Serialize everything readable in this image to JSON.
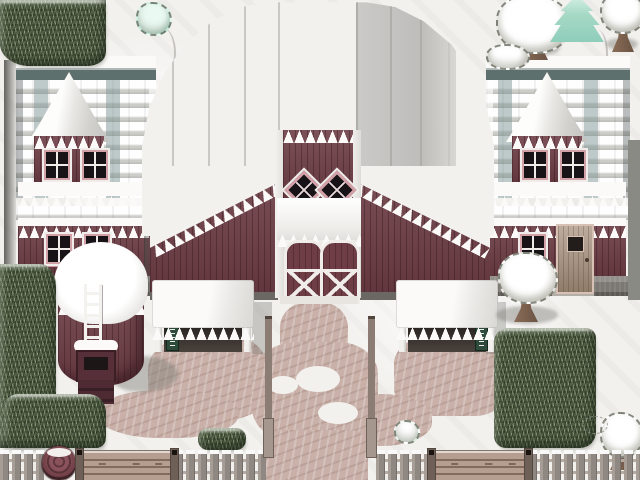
{
  "scene": {
    "type": "game-map",
    "style": "top-down 16-bit RPG tile map",
    "setting": "snow-covered red barn farmstead with silo, stalls, hedges and picket fence",
    "viewport": {
      "width": 640,
      "height": 480
    },
    "visible_text": "none"
  },
  "palette": {
    "snow": "#f3f1ee",
    "snow_bright": "#fbfaf8",
    "snow_shadow": "#dedcd8",
    "barn_red": "#6e3d45",
    "barn_red_dark": "#572f38",
    "trim_white": "#efece9",
    "trim_pink": "#d2a0a7",
    "sill_pink": "#cf9aa0",
    "roof_gray": "#c7c6c3",
    "roof_gray_dark": "#adadaa",
    "teal_shade": "#7e9694",
    "teal_dark": "#5e706e",
    "dirt": "#c9b1a9",
    "dirt_dark": "#b79e96",
    "grass_green": "#515f46",
    "grass_dark": "#39462f",
    "grass_light": "#a3b48a",
    "pine_teal": "#a6d9c6",
    "trunk_brown": "#7c6150",
    "fence_gray": "#9b938c",
    "fence_rail": "#b5aaa1",
    "gate_wood": "#b59d90",
    "gate_post": "#6f6057",
    "opening_dark": "#342e2b",
    "sign_green": "#2e4a3a",
    "foundation_gray": "#7b7772",
    "pane_black": "#171317",
    "door_wood": "#a8927e",
    "door_trim": "#d6c1b4",
    "ladder_white": "#f4f2ef"
  },
  "objects": {
    "viewport": "Snow-covered farmstead map",
    "barn_roof": "Large snow-covered gambrel barn roof",
    "barn_gable": "Red barn gable with icicles",
    "diamond_window": "Diamond window with four panes",
    "barn_doors": "White-framed barn double doors",
    "left_wing": "Left stable wing with dormer",
    "right_wing": "Right stable wing with dormer",
    "wing_window": "Four-pane window with pink sill",
    "wing_door": "Wooden side door with small window",
    "silo": "Red silo with snow cap",
    "silo_ladder": "White silo ladder",
    "feed_chute": "Feed chute box with steps",
    "stall_left": "Left feeding stall with snowy roof",
    "stall_right": "Right feeding stall with snowy roof",
    "stall_sign": "Small green sign in stall",
    "awning": "Snow-laden awning over barn doors",
    "fence": "Snow-capped picket fence",
    "gate_left": "Wooden plank gate",
    "gate_right": "Wooden plank gate",
    "barrel": "Round wooden barrel",
    "gatepost": "Tall wooden gatepost",
    "hedge": "Evergreen hedge block",
    "snow_tree": "Snow-covered tree",
    "conifer": "Frosted teal conifer",
    "sapling": "Small frosted sapling",
    "dirt_path": "Trampled dirt path in snow"
  }
}
